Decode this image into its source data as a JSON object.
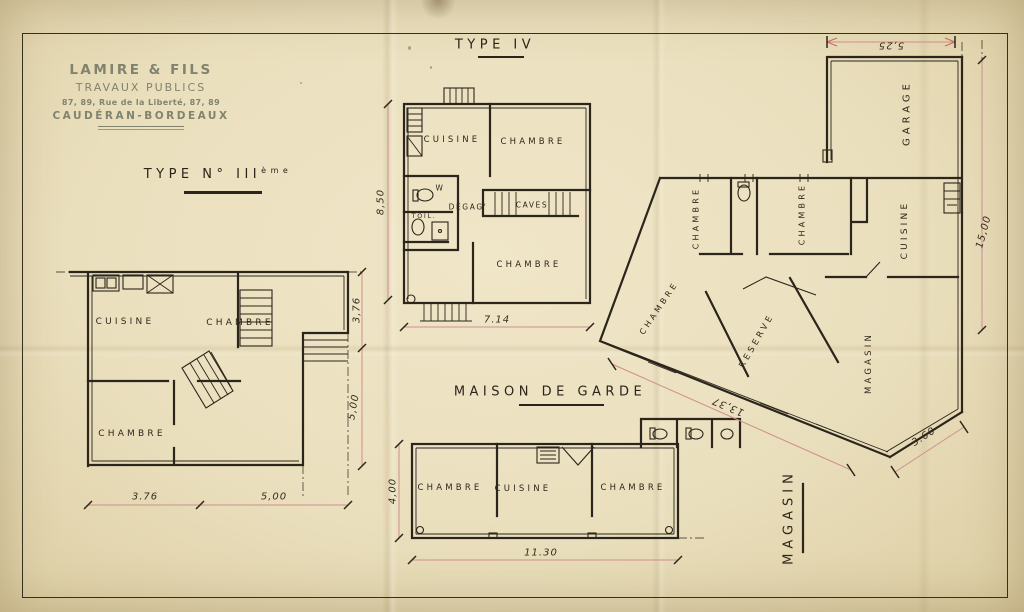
{
  "colors": {
    "paper": "#eadfbd",
    "ink": "#2b251b",
    "stamp_ink": "#82836e",
    "dim_line": "#cf8e8e"
  },
  "stamp": {
    "name": "LAMIRE & FILS",
    "subtitle": "TRAVAUX PUBLICS",
    "address": "87, 89, Rue de la Liberté, 87, 89",
    "city": "CAUDÉRAN-BORDEAUX"
  },
  "titles": {
    "type4": "TYPE IV",
    "type3": "TYPE N° III",
    "type3_sup": "ème",
    "maison_de_garde": "MAISON DE GARDE"
  },
  "type3_plan": {
    "rooms": {
      "cuisine": "CUISINE",
      "chambre_top": "CHAMBRE",
      "chambre_bottom": "CHAMBRE"
    },
    "dims": {
      "bottom_left": "3.76",
      "bottom_right": "5,00",
      "right_top": "3,76",
      "right_bottom": "5,00"
    }
  },
  "type4_plan": {
    "rooms": {
      "cuisine": "CUISINE",
      "chambre_top": "CHAMBRE",
      "wc": "W",
      "degagement": "DÉGAG'",
      "caves": "CAVES",
      "toilette": "TOIL.",
      "chambre_bottom": "CHAMBRE"
    },
    "dims": {
      "left": "8,50",
      "bottom": "7.14"
    }
  },
  "maison_de_garde_plan": {
    "rooms": {
      "chambre_left": "CHAMBRE",
      "cuisine": "CUISINE",
      "chambre_right": "CHAMBRE"
    },
    "dims": {
      "left": "4,00",
      "bottom": "11.30"
    }
  },
  "magasin_plan": {
    "rooms": {
      "garage": "GARAGE",
      "chambre_left": "CHAMBRE",
      "chambre_mid": "CHAMBRE",
      "chambre_diag": "CHAMBRE",
      "cuisine": "CUISINE",
      "reserve": "RESERVE",
      "magasin_inner": "MAGASIN"
    },
    "label_exterior": "MAGASIN",
    "dims": {
      "top": "5,25",
      "right": "15,00",
      "diag_left": "13,37",
      "diag_right": "3.60"
    }
  }
}
